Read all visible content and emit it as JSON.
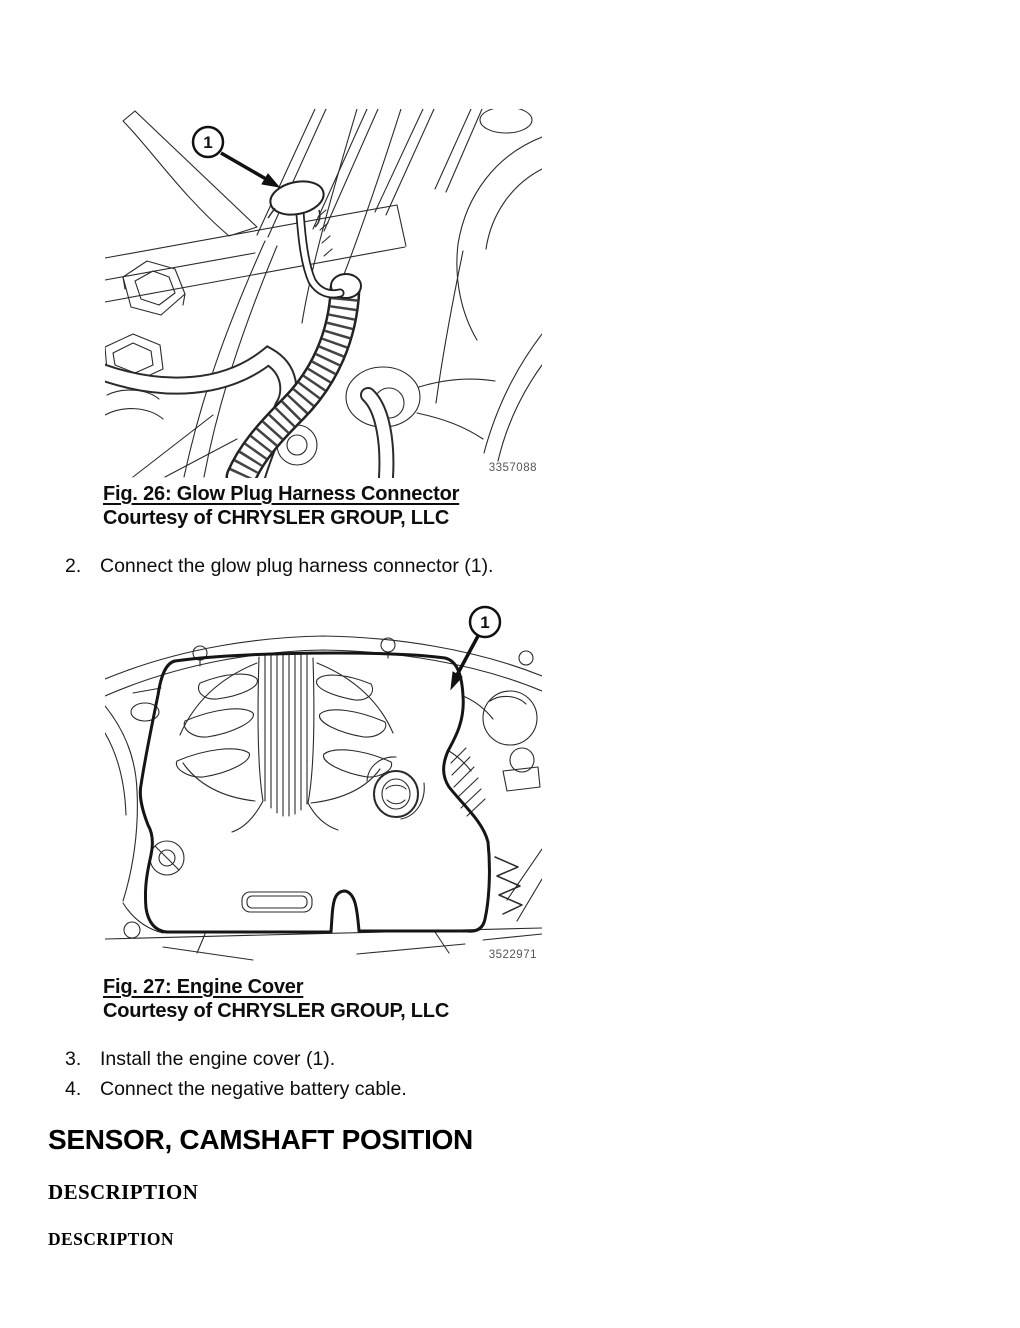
{
  "figures": {
    "fig26": {
      "callout": "1",
      "image_number": "3357088",
      "caption_title": "Fig. 26: Glow Plug Harness Connector",
      "caption_courtesy": "Courtesy of CHRYSLER GROUP, LLC"
    },
    "fig27": {
      "callout": "1",
      "image_number": "3522971",
      "caption_title": "Fig. 27: Engine Cover",
      "caption_courtesy": "Courtesy of CHRYSLER GROUP, LLC"
    }
  },
  "steps": [
    {
      "number": "2.",
      "text": "Connect the glow plug harness connector (1)."
    },
    {
      "number": "3.",
      "text": "Install the engine cover (1)."
    },
    {
      "number": "4.",
      "text": "Connect the negative battery cable."
    }
  ],
  "headings": {
    "section_title": "SENSOR, CAMSHAFT POSITION",
    "subsection_title": "DESCRIPTION",
    "subsubsection_title": "DESCRIPTION"
  },
  "colors": {
    "ink": "#111111",
    "line_art": "#2b2b2b",
    "image_number_gray": "#555555"
  }
}
